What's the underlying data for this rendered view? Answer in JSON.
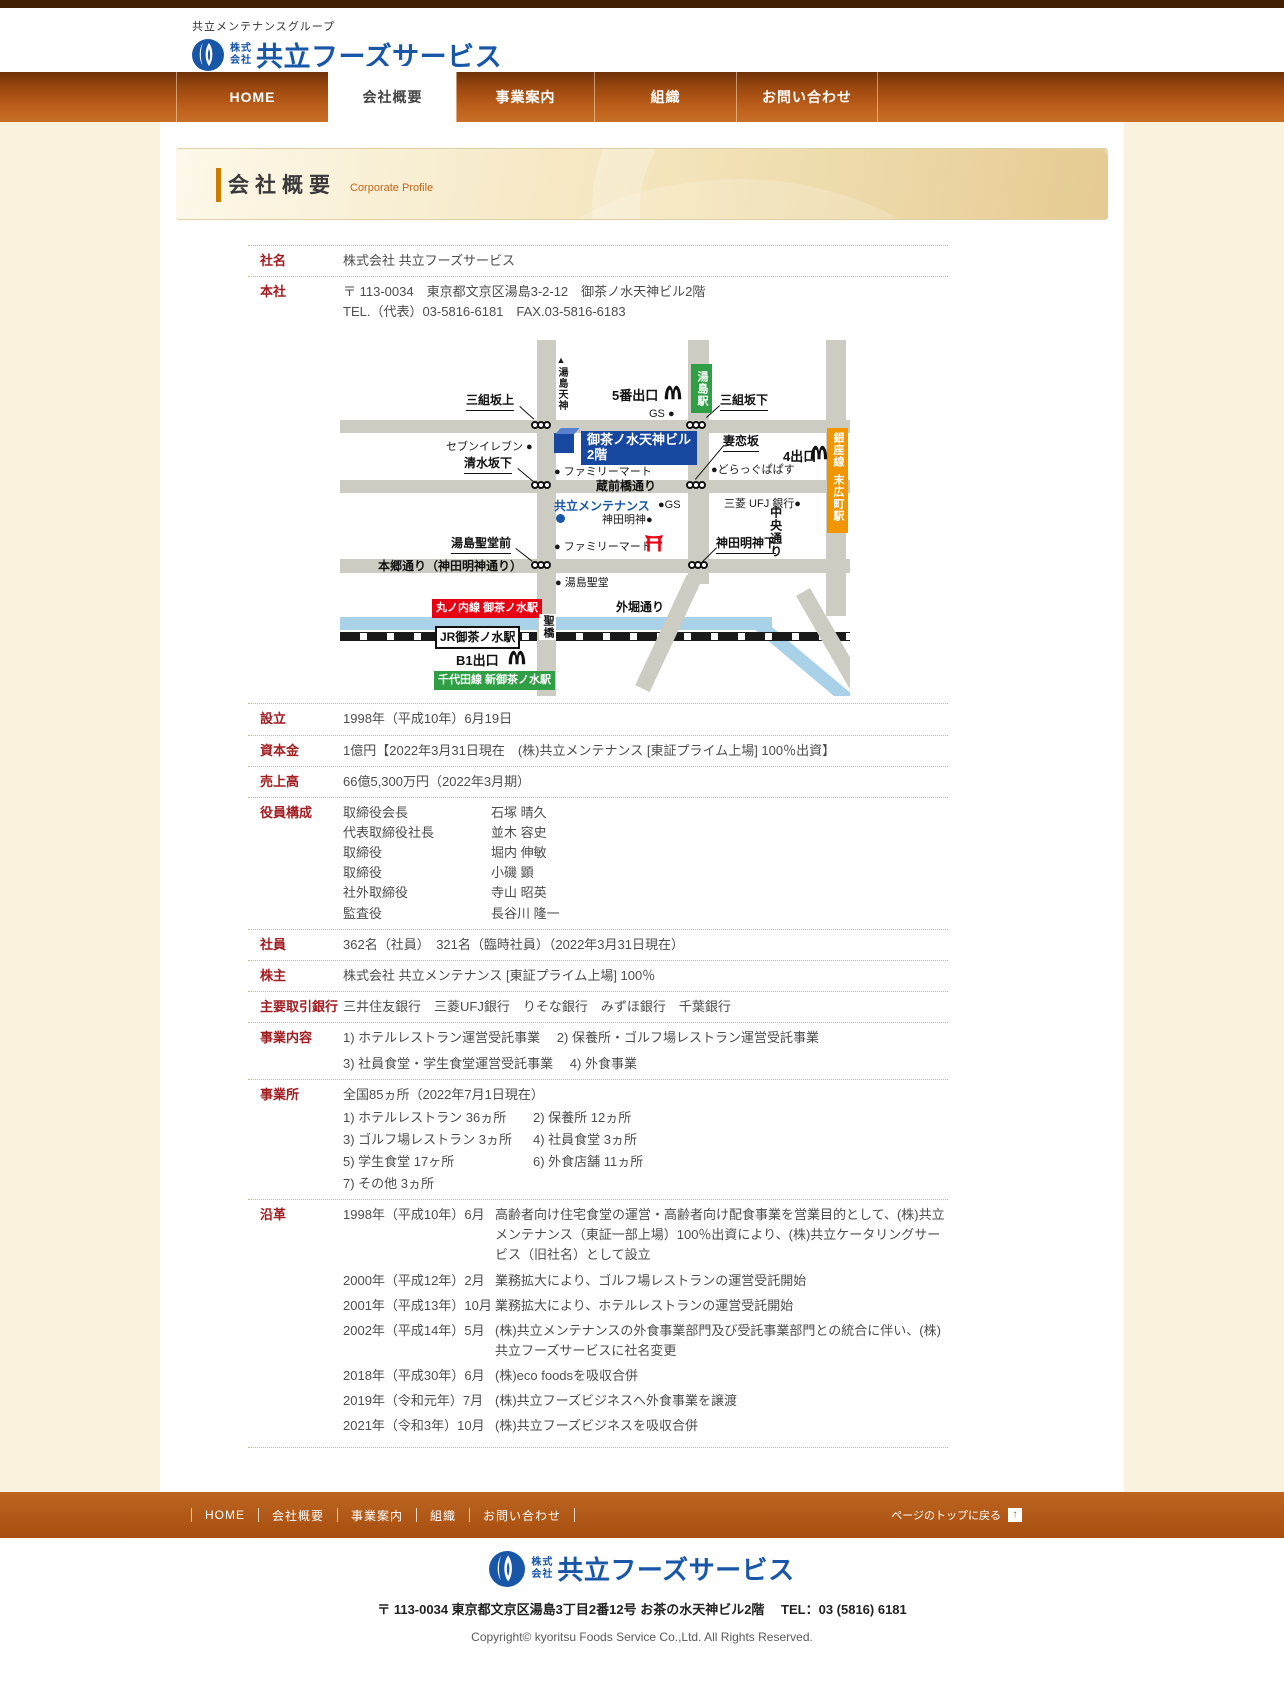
{
  "brand": {
    "group": "共立メンテナンスグループ",
    "kk_top": "株式",
    "kk_bottom": "会社",
    "name": "共立フーズサービス"
  },
  "nav": {
    "items": [
      "HOME",
      "会社概要",
      "事業案内",
      "組織",
      "お問い合わせ"
    ]
  },
  "title": {
    "ja": "会社概要",
    "en": "Corporate Profile"
  },
  "profile": {
    "shamei": {
      "label": "社名",
      "value": "株式会社 共立フーズサービス"
    },
    "honsha": {
      "label": "本社",
      "address": "〒 113-0034　東京都文京区湯島3-2-12　御茶ノ水天神ビル2階",
      "tel": "TEL.（代表）03-5816-6181　FAX.03-5816-6183"
    },
    "setsuritsu": {
      "label": "設立",
      "value": "1998年（平成10年）6月19日"
    },
    "shihonkin": {
      "label": "資本金",
      "value": "1億円【2022年3月31日現在　(株)共立メンテナンス [東証プライム上場] 100％出資】"
    },
    "uriage": {
      "label": "売上高",
      "value": "66億5,300万円（2022年3月期）"
    },
    "yakuin": {
      "label": "役員構成",
      "members": [
        {
          "title": "取締役会長",
          "name": "石塚 晴久"
        },
        {
          "title": "代表取締役社長",
          "name": "並木 容史"
        },
        {
          "title": "取締役",
          "name": "堀内 伸敏"
        },
        {
          "title": "取締役",
          "name": "小磯 顕"
        },
        {
          "title": "社外取締役",
          "name": "寺山 昭英"
        },
        {
          "title": "監査役",
          "name": "長谷川 隆一"
        }
      ]
    },
    "shain": {
      "label": "社員",
      "value": "362名（社員）　321名（臨時社員）（2022年3月31日現在）"
    },
    "kabunushi": {
      "label": "株主",
      "value": "株式会社 共立メンテナンス [東証プライム上場] 100％"
    },
    "ginko": {
      "label": "主要取引銀行",
      "value": "三井住友銀行　三菱UFJ銀行　りそな銀行　みずほ銀行　千葉銀行"
    },
    "naiyo": {
      "label": "事業内容",
      "line1": "1) ホテルレストラン運営受託事業　 2) 保養所・ゴルフ場レストラン運営受託事業",
      "line2": "3) 社員食堂・学生食堂運営受託事業　 4) 外食事業"
    },
    "jigyosho": {
      "label": "事業所",
      "heading": "全国85ヵ所（2022年7月1日現在）",
      "rows": [
        [
          "1) ホテルレストラン 36ヵ所",
          "2) 保養所 12ヵ所"
        ],
        [
          "3) ゴルフ場レストラン 3ヵ所",
          "4) 社員食堂 3ヵ所"
        ],
        [
          "5) 学生食堂 17ヶ所",
          "6) 外食店舗 11ヵ所"
        ],
        [
          "7) その他 3ヵ所",
          ""
        ]
      ]
    },
    "enkaku": {
      "label": "沿革",
      "events": [
        {
          "date": "1998年（平成10年）6月",
          "desc": "高齢者向け住宅食堂の運営・高齢者向け配食事業を営業目的として、(株)共立メンテナンス（東証一部上場）100％出資により、(株)共立ケータリングサービス（旧社名）として設立"
        },
        {
          "date": "2000年（平成12年）2月",
          "desc": "業務拡大により、ゴルフ場レストランの運営受託開始"
        },
        {
          "date": "2001年（平成13年）10月",
          "desc": "業務拡大により、ホテルレストランの運営受託開始"
        },
        {
          "date": "2002年（平成14年）5月",
          "desc": "(株)共立メンテナンスの外食事業部門及び受託事業部門との統合に伴い、(株)共立フーズサービスに社名変更"
        },
        {
          "date": "2018年（平成30年）6月",
          "desc": "(株)eco foodsを吸収合併"
        },
        {
          "date": "2019年（令和元年）7月",
          "desc": "(株)共立フーズビジネスへ外食事業を譲渡"
        },
        {
          "date": "2021年（令和3年）10月",
          "desc": "(株)共立フーズビジネスを吸収合併"
        }
      ]
    }
  },
  "map": {
    "yushima_tenjin": "湯島天神",
    "exit5": "5番出口",
    "yushima_station": "湯島駅",
    "misakizaka_ue": "三組坂上",
    "misakizaka_shita": "三組坂下",
    "gs_top": "GS ●",
    "seven_eleven": "セブンイレブン ●",
    "building_line1": "御茶ノ水天神ビル",
    "building_line2": "2階",
    "shimizuzaka_shita": "清水坂下",
    "familymart_top": "● ファミリーマート",
    "tsumakoizaka": "妻恋坂",
    "exit4": "4出口",
    "drug_papasu": "●どらっぐぱぱす",
    "kuramaebashi_dori": "蔵前橋通り",
    "ginza_line": "銀座線",
    "suehirocho_station": "末広町駅",
    "kyoritsu_maintenance": "共立メンテナンス",
    "gs_mid": "●GS",
    "kanda_myojin": "神田明神●",
    "mitsubishi_ufj": "三菱 UFJ 銀行●",
    "yushima_seido_mae": "湯島聖堂前",
    "familymart_mid": "● ファミリーマート",
    "kanda_myojin_shita": "神田明神下",
    "hongo_dori": "本郷通り（神田明神通り）",
    "yushima_seido": "● 湯島聖堂",
    "chuo_dori": "中央通り",
    "sotobori_dori": "外堀通り",
    "marunouchi_ochanomizu": "丸ノ内線 御茶ノ水駅",
    "seibashi": "聖橋",
    "jr_ochanomizu": "JR御茶ノ水駅",
    "b1_exit": "B1出口",
    "chiyoda_shin_ochanomizu": "千代田線 新御茶ノ水駅"
  },
  "footer": {
    "links": [
      "HOME",
      "会社概要",
      "事業案内",
      "組織",
      "お問い合わせ"
    ],
    "totop": "ページのトップに戻る",
    "totop_icon": "↑",
    "address": "〒 113-0034 東京都文京区湯島3丁目2番12号 お茶の水天神ビル2階　 TEL：03 (5816) 6181",
    "copyright": "Copyright© kyoritsu Foods Service Co.,Ltd. All Rights Reserved."
  },
  "colors": {
    "brand_blue": "#1856a8",
    "nav_orange": "#bc5f1a",
    "label_red": "#a11d21",
    "banner_accent": "#cc7a00"
  }
}
